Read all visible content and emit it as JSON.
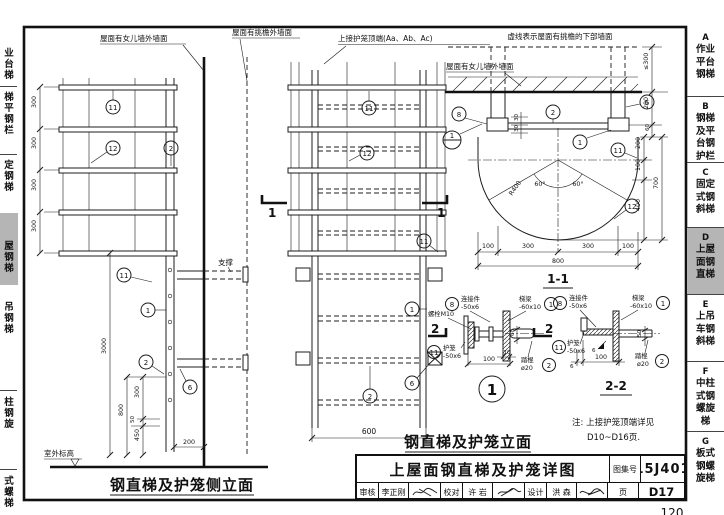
{
  "page": {
    "footer_page_number": "120"
  },
  "callout_numbers": {
    "n1": "1",
    "n2": "2",
    "n6": "6",
    "n8": "8",
    "n11": "11",
    "n12": "12"
  },
  "sidebar_left": {
    "items": [
      {
        "text": "业\n台\n梯"
      },
      {
        "text": "梯\n平\n钢\n栏"
      },
      {
        "text": "定\n钢\n梯"
      },
      {
        "text": "屋\n钢\n梯"
      },
      {
        "text": "吊\n钢\n梯"
      },
      {
        "text": "柱\n钢\n旋"
      },
      {
        "text": "式\n螺\n梯"
      }
    ]
  },
  "sidebar_right": {
    "items": [
      {
        "letter": "A",
        "text": "作业\n平台\n钢梯"
      },
      {
        "letter": "B",
        "text": "钢梯\n及平\n台钢\n护栏"
      },
      {
        "letter": "C",
        "text": "固定\n式钢\n斜梯"
      },
      {
        "letter": "D",
        "text": "上屋\n面钢\n直梯"
      },
      {
        "letter": "E",
        "text": "上吊\n车钢\n斜梯"
      },
      {
        "letter": "F",
        "text": "中柱\n式钢\n螺旋\n梯"
      },
      {
        "letter": "G",
        "text": "板式\n钢螺\n旋梯"
      }
    ]
  },
  "side_elevation": {
    "title": "钢直梯及护笼侧立面",
    "label_parapet_wall": "屋面有女儿墙外墙面",
    "label_eave_wall": "屋面有挑檐外墙面",
    "label_support": "支撑",
    "label_outdoor_level": "室外标高",
    "dim_hoop_spacing": "300",
    "dim_total_height": "3000",
    "dim_800": "800",
    "dim_300": "300",
    "dim_50": "50",
    "dim_450": "450",
    "dim_200": "200"
  },
  "front_elevation": {
    "title": "钢直梯及护笼立面",
    "label_cage_top": "上接护笼顶端(Aa、Ab、Ac)",
    "dim_width": "600",
    "section_mark": "1"
  },
  "plan": {
    "title": "1-1",
    "label_dashed_note": "虚线表示屋面有挑檐的下部墙面",
    "label_parapet_wall": "屋面有女儿墙外墙面",
    "dim_le300": "≤300",
    "dim_200": "200",
    "dim_60": "60",
    "dim_100": "100",
    "dim_400": "400",
    "dim_700": "700",
    "dim_30": "30",
    "dim_300": "300",
    "dim_800": "800",
    "radius": "R400",
    "angle": "60°"
  },
  "detail_1": {
    "bubble": "1",
    "section_mark": "2",
    "label_bolt": "螺栓M10",
    "label_connector": "连接件",
    "size_connector": "-50x6",
    "label_beam": "梯梁",
    "size_beam": "-60x10",
    "label_cage": "护笼",
    "size_cage": "-50x6",
    "label_rung": "踏棍",
    "size_rung": "ø20",
    "dim_10": "10",
    "dim_100": "100",
    "dim_60": "60"
  },
  "detail_2_2": {
    "title": "2-2",
    "label_connector": "连接件",
    "size_connector": "-50x6",
    "label_beam": "梯梁",
    "size_beam": "-60x10",
    "label_cage": "护笼",
    "size_cage": "-50x6",
    "label_rung": "踏棍",
    "size_rung": "ø20",
    "dim_6": "6",
    "dim_100": "100",
    "dim_50": "50",
    "weld_size": "6"
  },
  "note": {
    "line1": "注: 上接护笼顶端详见",
    "line2": "D10~D16页."
  },
  "titleblock": {
    "drawing_title": "上屋面钢直梯及护笼详图",
    "atlas_label": "图集号",
    "atlas_no": "15J401",
    "page_label": "页",
    "page_no": "D17",
    "check_label": "审核",
    "check_name": "李正刚",
    "proof_label": "校对",
    "proof_name": "许 岩",
    "design_label": "设计",
    "design_name": "洪 森"
  }
}
